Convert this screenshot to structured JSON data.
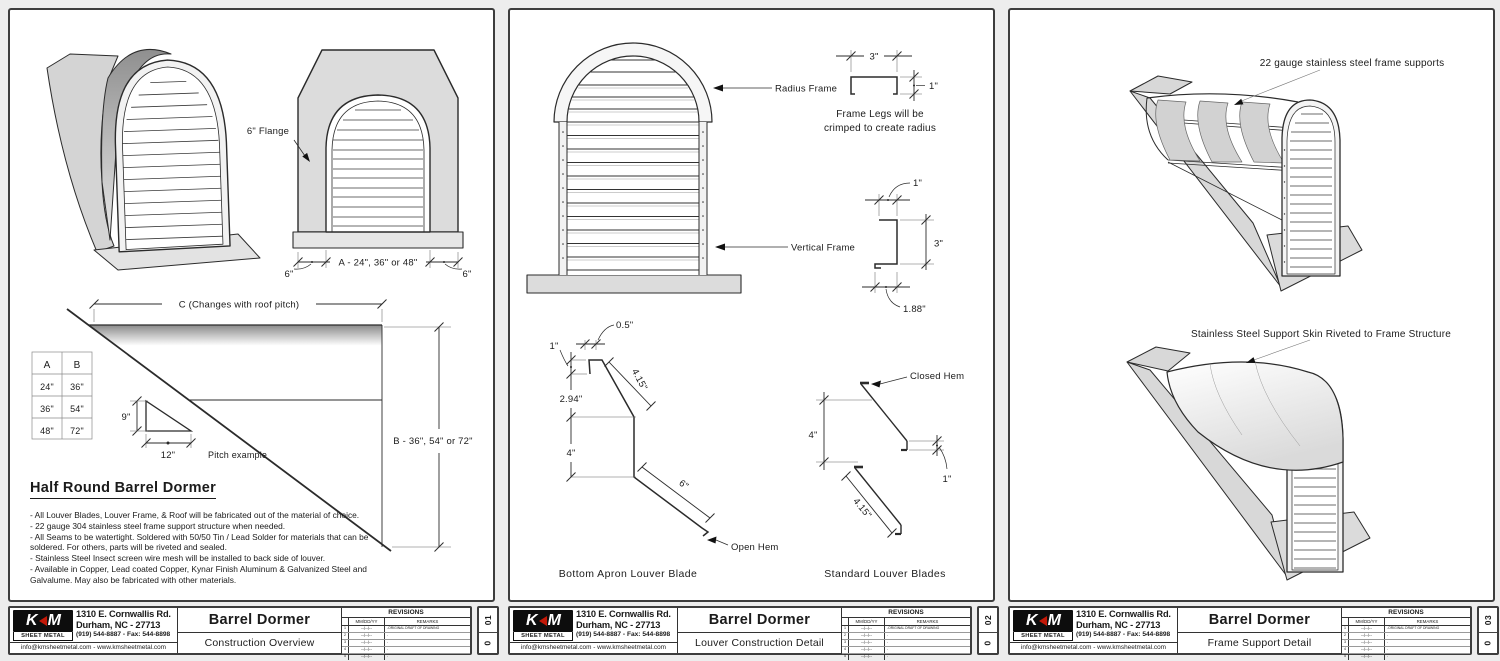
{
  "page": {
    "background": "#ededed",
    "line_color": "#2b2b2b",
    "accent_red": "#c21807"
  },
  "company": {
    "logo_k": "K",
    "logo_m": "M",
    "logo_tagline": "SHEET METAL",
    "address_line1": "1310 E. Cornwallis Rd.",
    "address_line2": "Durham, NC - 27713",
    "phone_line": "(919) 544-8887 - Fax: 544-8898",
    "contact_line": "info@kmsheetmetal.com - www.kmsheetmetal.com"
  },
  "revisions": {
    "title": "REVISIONS",
    "date_header": "MM/DD/YY",
    "remarks_header": "REMARKS",
    "rows": [
      {
        "n": "1",
        "date": "--/--/--",
        "remark": "-ORIGINAL DRAFT OF DRAWING"
      },
      {
        "n": "2",
        "date": "--/--/--",
        "remark": "-"
      },
      {
        "n": "3",
        "date": "--/--/--",
        "remark": "-"
      },
      {
        "n": "4",
        "date": "--/--/--",
        "remark": "-"
      },
      {
        "n": "5",
        "date": "--/--/--",
        "remark": "-"
      }
    ]
  },
  "sheets": [
    {
      "title": "Barrel Dormer",
      "subtitle": "Construction Overview",
      "sheet_no": "01",
      "rev": "0"
    },
    {
      "title": "Barrel Dormer",
      "subtitle": "Louver Construction Detail",
      "sheet_no": "02",
      "rev": "0"
    },
    {
      "title": "Barrel Dormer",
      "subtitle": "Frame Support Detail",
      "sheet_no": "03",
      "rev": "0"
    }
  ],
  "overview": {
    "heading": "Half Round Barrel Dormer",
    "notes": [
      "- All Louver Blades, Louver Frame, & Roof will be fabricated out of the material of choice.",
      "- 22 gauge 304 stainless steel frame support structure when needed.",
      "- All Seams to be watertight. Soldered with 50/50 Tin / Lead Solder for materials that can be soldered. For others, parts will be riveted and sealed.",
      "- Stainless Steel Insect screen wire mesh will be installed to back side of louver.",
      "- Available in Copper, Lead coated Copper, Kynar Finish Aluminum & Galvanized Steel and Galvalume. May also be fabricated with other materials."
    ],
    "dims": {
      "flange": "6\" Flange",
      "six": "6\"",
      "width_a": "A - 24\", 36\" or 48\"",
      "span_c": "C (Changes with roof pitch)",
      "height_b": "B - 36\", 54\" or 72\"",
      "rise": "9\"",
      "run": "12\"",
      "pitch_caption": "Pitch example"
    },
    "size_table": {
      "headers": [
        "A",
        "B"
      ],
      "rows": [
        [
          "24\"",
          "36\""
        ],
        [
          "36\"",
          "54\""
        ],
        [
          "48\"",
          "72\""
        ]
      ]
    }
  },
  "louver_detail": {
    "labels": {
      "radius_frame": "Radius Frame",
      "vertical_frame": "Vertical Frame",
      "crimp_line1": "Frame Legs will be",
      "crimp_line2": "crimped to create radius",
      "open_hem": "Open Hem",
      "closed_hem": "Closed Hem",
      "caption_apron": "Bottom Apron Louver Blade",
      "caption_standard": "Standard Louver Blades"
    },
    "dims": {
      "d_05": "0.5\"",
      "d_1": "1\"",
      "d_188": "1.88\"",
      "d_294": "2.94\"",
      "d_3": "3\"",
      "d_4": "4\"",
      "d_415": "4.15\"",
      "d_6": "6\""
    }
  },
  "frame_detail": {
    "labels": {
      "supports": "22 gauge stainless steel frame supports",
      "skin": "Stainless Steel Support Skin Riveted to Frame Structure"
    }
  }
}
